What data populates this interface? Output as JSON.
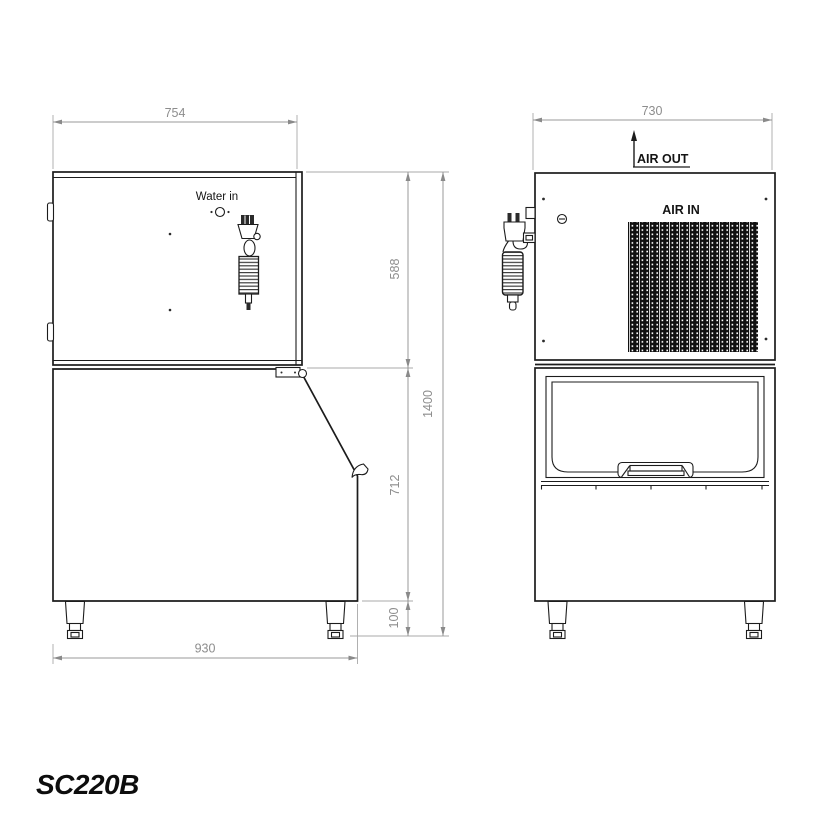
{
  "title": "SC220B",
  "colors": {
    "line": "#1c1c1c",
    "dimension": "#8d8d8d",
    "label": "#141414",
    "grille": "#101010",
    "background": "#ffffff"
  },
  "side_view": {
    "labels": {
      "water_in": "Water in"
    },
    "dims": {
      "top_width": "754",
      "upper_height": "588",
      "lower_height": "712",
      "foot_height": "100",
      "total_height": "1400",
      "base_depth": "930"
    }
  },
  "front_view": {
    "labels": {
      "air_out": "AIR OUT",
      "air_in": "AIR IN"
    },
    "dims": {
      "width": "730"
    }
  }
}
